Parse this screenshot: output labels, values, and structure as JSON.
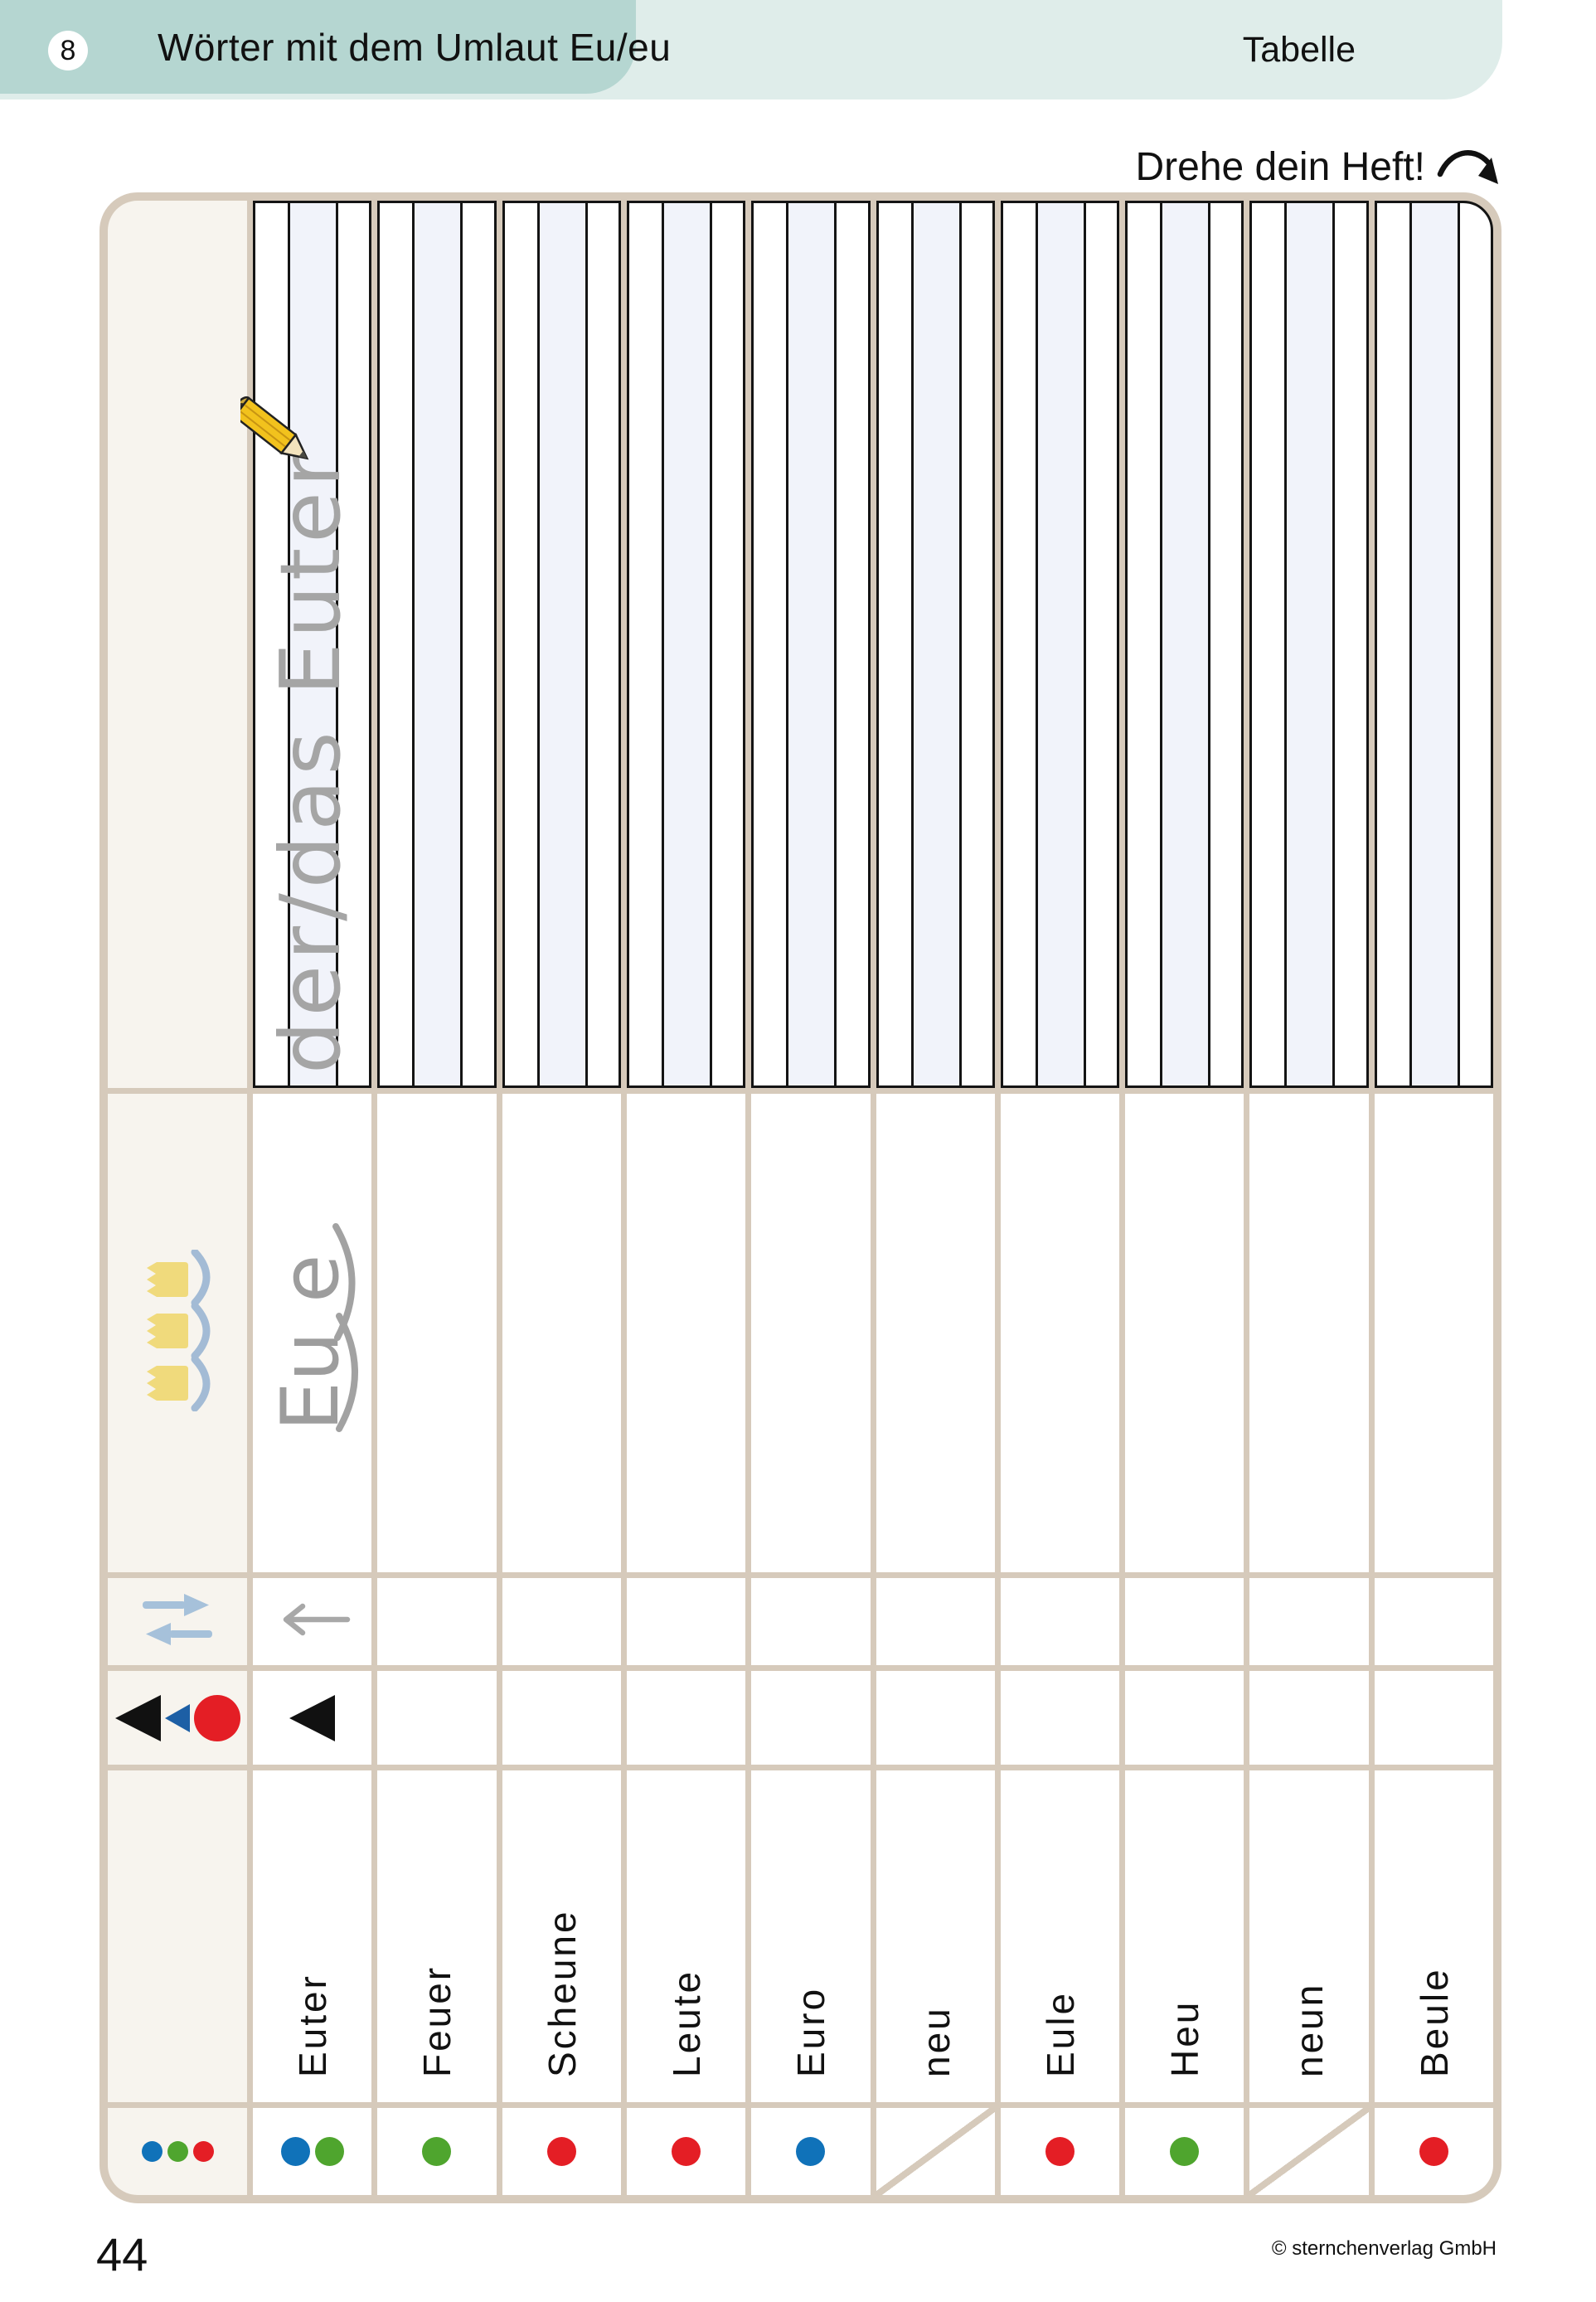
{
  "header": {
    "lesson_number": "8",
    "title": "Wörter mit dem Umlaut Eu/eu",
    "category": "Tabelle"
  },
  "instruction": {
    "text": "Drehe dein Heft!"
  },
  "table": {
    "trace_text": "der/das Euter",
    "syllable_example": {
      "first": "Eu",
      "second": "e"
    },
    "words": [
      "Euter",
      "Feuer",
      "Scheune",
      "Leute",
      "Euro",
      "neu",
      "Eule",
      "Heu",
      "neun",
      "Beule"
    ],
    "legend_dots": [
      "blue",
      "green",
      "red"
    ],
    "dots": [
      [
        "blue",
        "green"
      ],
      [
        "green"
      ],
      [
        "red"
      ],
      [
        "red"
      ],
      [
        "blue"
      ],
      "slash",
      [
        "red"
      ],
      [
        "green"
      ],
      "slash",
      [
        "red"
      ]
    ]
  },
  "footer": {
    "page_number": "44",
    "copyright": "© sternchenverlag GmbH"
  },
  "colors": {
    "band_dark": "#b5d6d1",
    "band_light": "#dfedea",
    "grid_beige": "#d6cabb",
    "header_cream": "#f7f4ee",
    "lineature_fill": "#f1f3fa",
    "line_black": "#141414",
    "handwriting_gray": "#a5a5a5",
    "icon_blue": "#a6c1da",
    "crown_yellow": "#f0da7c",
    "arc_blue": "#a3bbd5",
    "dot_blue": "#1072b9",
    "dot_green": "#4fa52e",
    "dot_red": "#e41e25",
    "tri_blue": "#1d5fa5"
  }
}
